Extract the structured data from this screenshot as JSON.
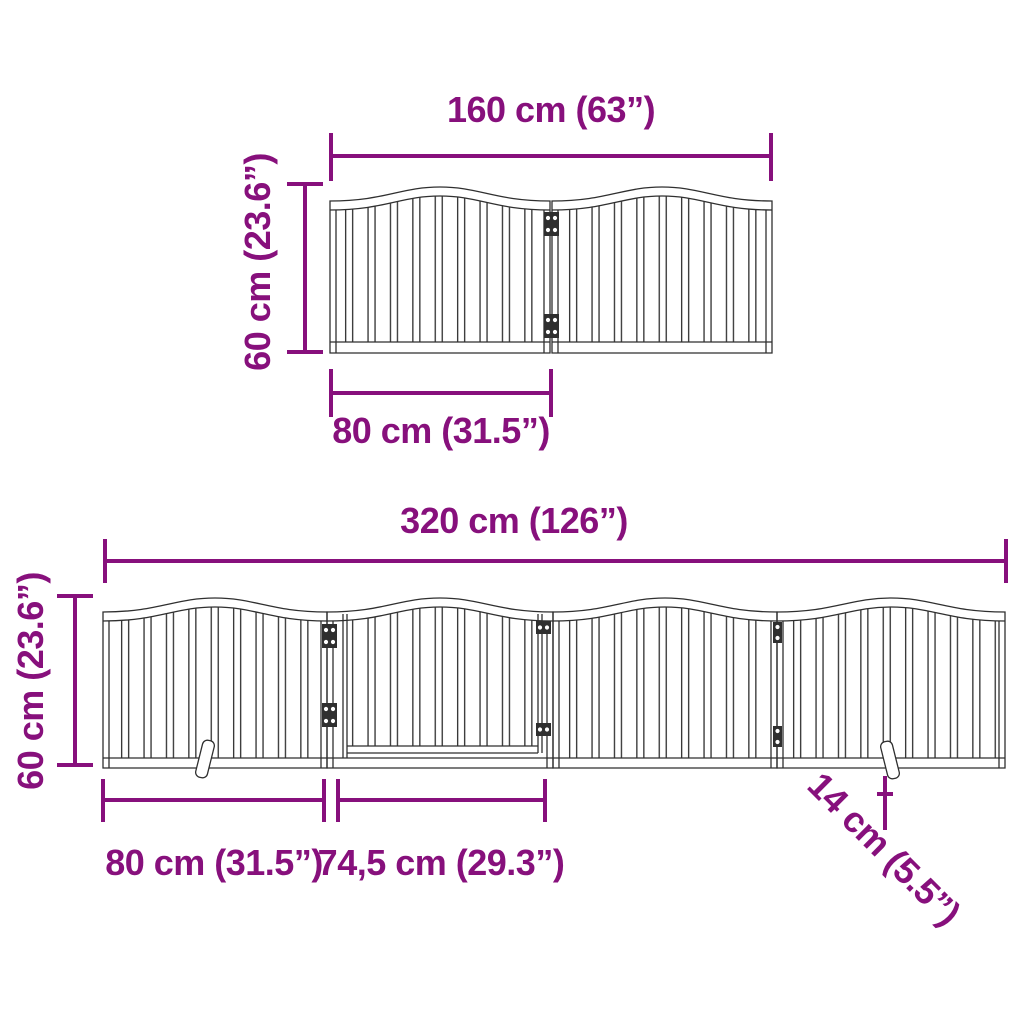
{
  "page": {
    "background": "#ffffff",
    "accent_color": "#87107C",
    "drawing_line_color": "#2f2f2f"
  },
  "top_diagram": {
    "panel_count": 2,
    "width_label": "160 cm (63”)",
    "height_label": "60 cm (23.6”)",
    "panel_width_label": "80 cm (31.5”)"
  },
  "bottom_diagram": {
    "panel_count": 4,
    "width_label": "320 cm (126”)",
    "height_label": "60 cm (23.6”)",
    "panel_width_label": "80 cm (31.5”)",
    "door_width_label": "74,5 cm (29.3”)",
    "foot_depth_label": "14 cm (5.5”)"
  }
}
